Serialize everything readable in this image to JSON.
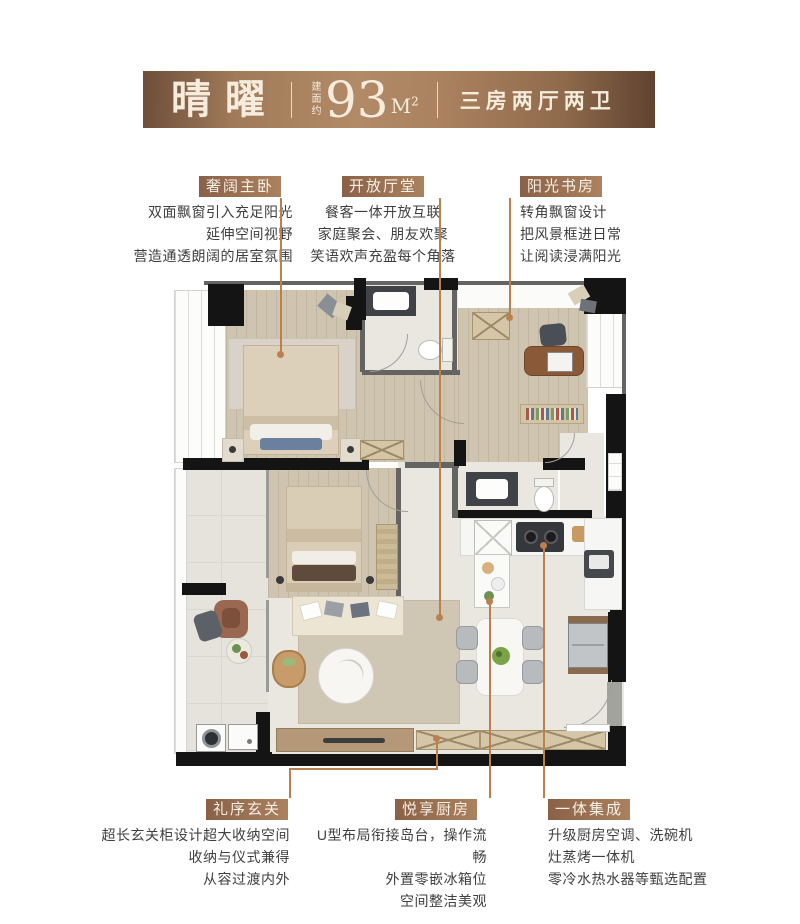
{
  "header": {
    "name": "晴曜",
    "area_prefix": "建面约",
    "area_value": "93",
    "area_unit": "M",
    "area_sup": "2",
    "layout": "三房两厅两卫"
  },
  "callouts": {
    "master_bedroom": {
      "label": "奢阔主卧",
      "lines": [
        "双面飘窗引入充足阳光",
        "延伸空间视野",
        "营造通透朗阔的居室氛围"
      ]
    },
    "living_hall": {
      "label": "开放厅堂",
      "lines": [
        "餐客一体开放互联",
        "家庭聚会、朋友欢聚",
        "笑语欢声充盈每个角落"
      ]
    },
    "study": {
      "label": "阳光书房",
      "lines": [
        "转角飘窗设计",
        "把风景框进日常",
        "让阅读浸满阳光"
      ]
    },
    "foyer": {
      "label": "礼序玄关",
      "lines": [
        "超长玄关柜设计超大收纳空间",
        "收纳与仪式兼得",
        "从容过渡内外"
      ]
    },
    "kitchen": {
      "label": "悦享厨房",
      "lines": [
        "U型布局衔接岛台，操作流畅",
        "外置零嵌冰箱位",
        "空间整洁美观"
      ]
    },
    "integrated": {
      "label": "一体集成",
      "lines": [
        "升级厨房空调、洗碗机",
        "灶蒸烤一体机",
        "零冷水热水器等甄选配置"
      ]
    }
  },
  "colors": {
    "header_brown": "#a07a59",
    "badge_brown": "#9a714f",
    "leader_line": "#bb8050",
    "body_text": "#3f3f3f"
  }
}
